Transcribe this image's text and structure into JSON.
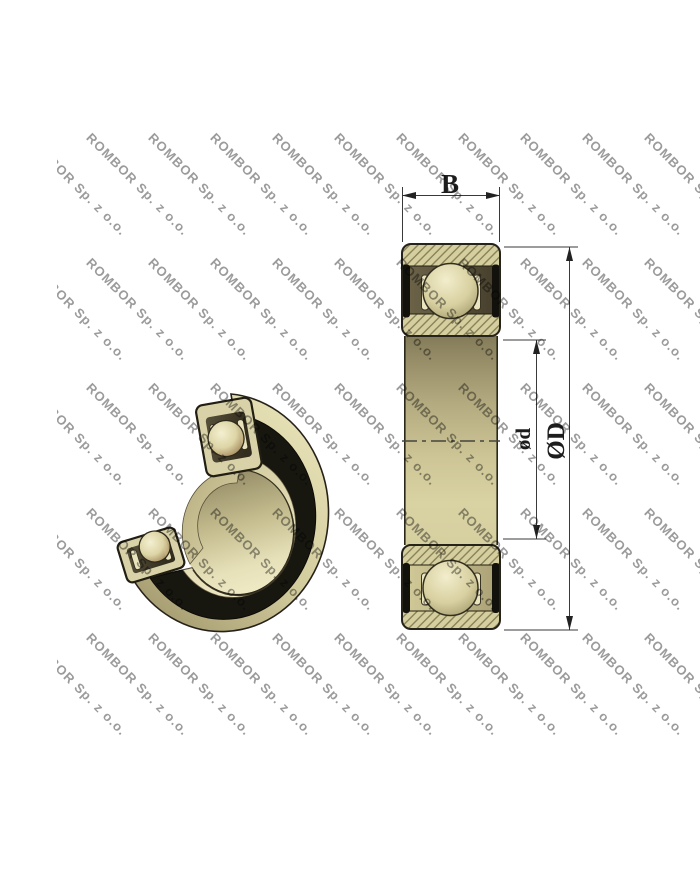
{
  "watermark": {
    "text": "ROMBOR Sp. z o.o.",
    "color": "#9b9b9b",
    "grid": {
      "rows": 5,
      "cols": 12,
      "x0": -25,
      "y0": 18,
      "dx": 62,
      "dy": 125,
      "angle_deg": 45
    }
  },
  "cross_section": {
    "label_width": "B",
    "label_bore": "ød",
    "label_outer": "ØD"
  },
  "palette": {
    "steel_tan": "#d5ce9e",
    "steel_light": "#ece6c0",
    "hatch_line": "#8a8258",
    "dark_border": "#26231a",
    "seal_black": "#12110c",
    "cage_dark": "#463f2c",
    "dim_line": "#3a3a3a",
    "background": "#ffffff"
  }
}
